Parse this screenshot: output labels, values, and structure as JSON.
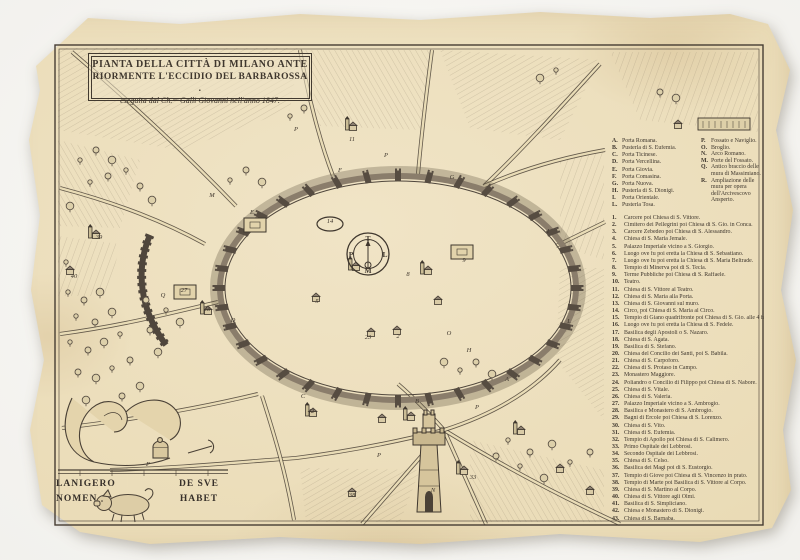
{
  "title": {
    "line1": "PIANTA DELLA CITTÀ DI  MILANO ANTE",
    "line2": "RIORMENTE L'ECCIDIO DEL BARBAROSSA .",
    "line3": "eseguita dal Ch.ᵐᵒ Galli Giovanni nell'anno 1847."
  },
  "compass": {
    "north": "T",
    "south": "M",
    "west": "P",
    "east": "L"
  },
  "motto": {
    "left_line1": "LANIGERO",
    "left_line2": "NOMEN",
    "right_line1": "DE SVE",
    "right_line2": "HABET"
  },
  "palette": {
    "ink": "#3f372e",
    "paper": "#e9dab4",
    "wall": "#564c41",
    "hatch": "#8d8069"
  },
  "legend": {
    "gates_col1": [
      {
        "key": "A.",
        "label": "Porta Romana."
      },
      {
        "key": "B.",
        "label": "Pusterla di S. Eufemia."
      },
      {
        "key": "C.",
        "label": "Porta Ticinese."
      },
      {
        "key": "D.",
        "label": "Porta Vercellina."
      },
      {
        "key": "E.",
        "label": "Porta Giovia."
      },
      {
        "key": "F.",
        "label": "Porta Comasina."
      },
      {
        "key": "G.",
        "label": "Porta Nuova."
      },
      {
        "key": "H.",
        "label": "Pusterla di S. Dionigi."
      },
      {
        "key": "I.",
        "label": "Porta Orientale."
      },
      {
        "key": "L.",
        "label": "Pusterla Tosa."
      }
    ],
    "gates_col2": [
      {
        "key": "P.",
        "label": "Fossato e Naviglio."
      },
      {
        "key": "O.",
        "label": "Broglio."
      },
      {
        "key": "N.",
        "label": "Arco Romano."
      },
      {
        "key": "M.",
        "label": "Porte del Fossato."
      },
      {
        "key": "Q.",
        "label": "Antico braccio delle mura di Massimiano."
      },
      {
        "key": "R.",
        "label": "Ampliazione delle mura per opera dell'Arcivescovo Ansperto."
      }
    ],
    "sites": [
      {
        "num": "1.",
        "label": "Carcere poi Chiesa di S. Vittore."
      },
      {
        "num": "2.",
        "label": "Cimitero dei Pellegrini poi Chiesa di S. Gio. in Conca."
      },
      {
        "num": "3.",
        "label": "Carcere Zebedeo poi Chiesa di S. Alessandro."
      },
      {
        "num": "4.",
        "label": "Chiesa di S. Maria Jemale."
      },
      {
        "num": "5.",
        "label": "Palazzo Imperiale vicino a S. Giorgio."
      },
      {
        "num": "6.",
        "label": "Luogo ove fu poi eretta la Chiesa di S. Sebastiano."
      },
      {
        "num": "7.",
        "label": "Luogo ove fu poi eretta la Chiesa di S. Maria Beltrade."
      },
      {
        "num": "8.",
        "label": "Tempio di Minerva poi di S. Tecla."
      },
      {
        "num": "9.",
        "label": "Terme Pubbliche poi Chiesa di S. Raffaele."
      },
      {
        "num": "10.",
        "label": "Teatro."
      },
      {
        "num": "11.",
        "label": "Chiesa di S. Vittore al Teatro."
      },
      {
        "num": "12.",
        "label": "Chiesa di S. Maria alla Porta."
      },
      {
        "num": "13.",
        "label": "Chiesa di S. Giovanni sul muro."
      },
      {
        "num": "14.",
        "label": "Circo, poi Chiesa di S. Maria al Circo."
      },
      {
        "num": "15.",
        "label": "Tempio di Giano quadrifronte poi Chiesa di S. Gio. alle 4 faccie."
      },
      {
        "num": "16.",
        "label": "Luogo ove fu poi eretta la Chiesa di S. Fedele."
      },
      {
        "num": "17.",
        "label": "Basilica degli Apostoli o S. Nazaro."
      },
      {
        "num": "18.",
        "label": "Chiesa di S. Agata."
      },
      {
        "num": "19.",
        "label": "Basilica di S. Stefano."
      },
      {
        "num": "20.",
        "label": "Chiesa del Concilio dei Santi, poi S. Babila."
      },
      {
        "num": "21.",
        "label": "Chiesa di S. Carpoforo."
      },
      {
        "num": "22.",
        "label": "Chiesa di S. Protaso in Campo."
      },
      {
        "num": "23.",
        "label": "Monastero Maggiore."
      },
      {
        "num": "24.",
        "label": "Poliandro o Concilio di Filippo poi Chiesa di S. Nabore."
      },
      {
        "num": "25.",
        "label": "Chiesa di S. Vitale."
      },
      {
        "num": "26.",
        "label": "Chiesa di S. Valeria."
      },
      {
        "num": "27.",
        "label": "Palazzo Imperiale vicino a S. Ambrogio."
      },
      {
        "num": "28.",
        "label": "Basilica e Monastero di S. Ambrogio."
      },
      {
        "num": "29.",
        "label": "Bagni di Ercole poi Chiesa di S. Lorenzo."
      },
      {
        "num": "30.",
        "label": "Chiesa di S. Vito."
      },
      {
        "num": "31.",
        "label": "Chiesa di S. Eufemia."
      },
      {
        "num": "32.",
        "label": "Tempio di Apollo poi Chiesa di S. Calimero."
      },
      {
        "num": "33.",
        "label": "Primo Ospitale dei Lebbrosi."
      },
      {
        "num": "34.",
        "label": "Secondo Ospitale dei Lebbrosi."
      },
      {
        "num": "35.",
        "label": "Chiesa di S. Celso."
      },
      {
        "num": "36.",
        "label": "Basilica dei Magi poi di S. Eustorgio."
      },
      {
        "num": "37.",
        "label": "Tempio di Giove poi Chiesa di S. Vincenzo in prato."
      },
      {
        "num": "38.",
        "label": "Tempio di Marte poi Basilica di S. Vittore al Corpo."
      },
      {
        "num": "39.",
        "label": "Chiesa di S. Martino al Corpo."
      },
      {
        "num": "40.",
        "label": "Chiesa di S. Vittore agli Olmi."
      },
      {
        "num": "41.",
        "label": "Basilica di S. Simpliciano."
      },
      {
        "num": "42.",
        "label": "Chiesa e Monastero di S. Dionigi."
      },
      {
        "num": "43.",
        "label": "Chiesa di S. Barnaba."
      }
    ]
  },
  "map_labels": [
    {
      "t": "M",
      "x": 212,
      "y": 197
    },
    {
      "t": "P",
      "x": 296,
      "y": 131
    },
    {
      "t": "P",
      "x": 386,
      "y": 157
    },
    {
      "t": "E",
      "x": 252,
      "y": 214
    },
    {
      "t": "F",
      "x": 340,
      "y": 172
    },
    {
      "t": "G",
      "x": 452,
      "y": 179
    },
    {
      "t": "I",
      "x": 548,
      "y": 233
    },
    {
      "t": "L",
      "x": 569,
      "y": 323
    },
    {
      "t": "A",
      "x": 507,
      "y": 381
    },
    {
      "t": "H",
      "x": 469,
      "y": 352
    },
    {
      "t": "B",
      "x": 417,
      "y": 403
    },
    {
      "t": "C",
      "x": 303,
      "y": 398
    },
    {
      "t": "D",
      "x": 233,
      "y": 322
    },
    {
      "t": "O",
      "x": 449,
      "y": 335
    },
    {
      "t": "N",
      "x": 433,
      "y": 492
    },
    {
      "t": "Q",
      "x": 163,
      "y": 297
    },
    {
      "t": "P",
      "x": 477,
      "y": 409
    },
    {
      "t": "P",
      "x": 379,
      "y": 457
    },
    {
      "t": "P",
      "x": 148,
      "y": 466
    },
    {
      "t": "5",
      "x": 317,
      "y": 303
    },
    {
      "t": "8",
      "x": 408,
      "y": 276
    },
    {
      "t": "9",
      "x": 464,
      "y": 262
    },
    {
      "t": "2",
      "x": 398,
      "y": 338
    },
    {
      "t": "23",
      "x": 368,
      "y": 339
    },
    {
      "t": "11",
      "x": 352,
      "y": 141
    },
    {
      "t": "14",
      "x": 330,
      "y": 223
    },
    {
      "t": "27",
      "x": 184,
      "y": 292
    },
    {
      "t": "28",
      "x": 207,
      "y": 311
    },
    {
      "t": "39",
      "x": 99,
      "y": 239
    },
    {
      "t": "40",
      "x": 74,
      "y": 278
    },
    {
      "t": "33",
      "x": 473,
      "y": 479
    },
    {
      "t": "38",
      "x": 352,
      "y": 497
    },
    {
      "t": "42",
      "x": 311,
      "y": 413
    }
  ]
}
